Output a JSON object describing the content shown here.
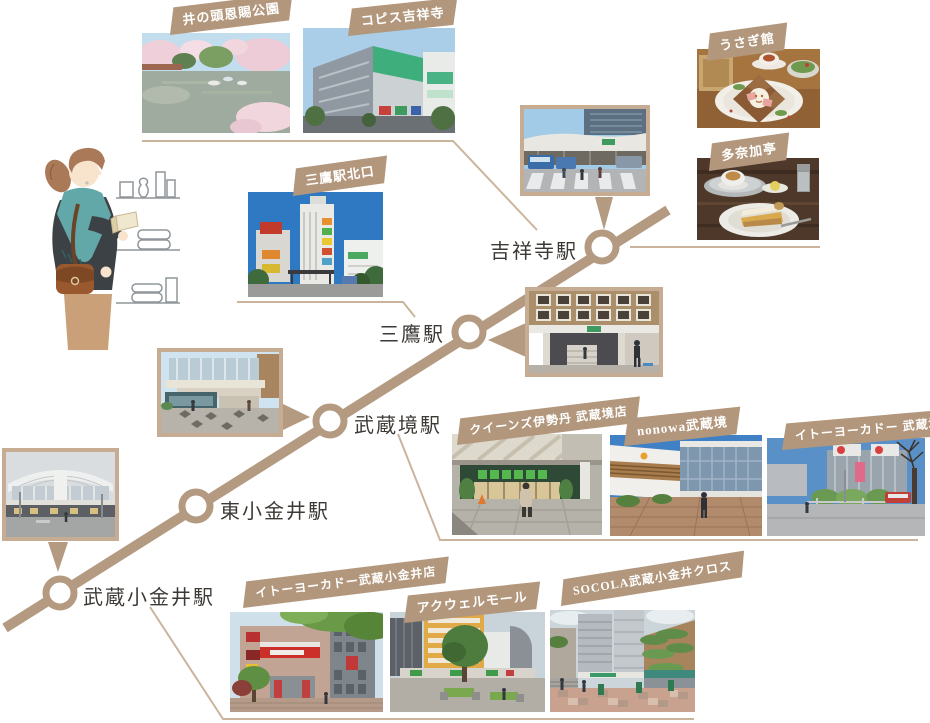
{
  "palette": {
    "rail_line": "#b49a80",
    "ribbon_bg": "#b2977c",
    "connector_line": "#cbb49c",
    "station_text": "#3d3935",
    "photo_border": "#c5ac93",
    "background": "#ffffff"
  },
  "stations": {
    "kichijoji": "吉祥寺駅",
    "mitaka": "三鷹駅",
    "musashisakai": "武蔵境駅",
    "higashikoganei": "東小金井駅",
    "musashikoganei": "武蔵小金井駅"
  },
  "ribbons": {
    "inokashira": "井の頭恩賜公園",
    "coppice": "コピス吉祥寺",
    "usagikan": "うさぎ館",
    "tanakatei": "多奈加亭",
    "mitaka_north": "三鷹駅北口",
    "queens_isetan": "クイーンズ伊勢丹 武蔵境店",
    "nonowa": "nonowa武蔵境",
    "itoyokado_sakai": "イトーヨーカドー 武蔵境店",
    "itoyokado_koganei": "イトーヨーカドー武蔵小金井店",
    "acwell": "アクウェルモール",
    "socola": "SOCOLA武蔵小金井クロス"
  },
  "photos": {
    "inokashira": "pond-with-cherry-blossoms-and-boats",
    "coppice": "green-shopping-center-building",
    "usagikan": "galette-set-on-wooden-table",
    "tanakatei": "cake-slice-with-coffee",
    "mitaka_north": "street-view-buildings-blue-sky",
    "kichijoji_station": "station-building-bus-terminal",
    "mitaka_station": "station-entrance",
    "musashisakai_station": "elevated-station-plaza",
    "musashikoganei_station": "station-facade",
    "queens_isetan": "supermarket-storefront",
    "nonowa": "station-mall-exterior",
    "itoyokado_sakai": "shopping-center-rotary",
    "itoyokado_koganei": "department-store-building",
    "acwell": "mall-plaza-with-tree",
    "socola": "shopping-complex-plaza"
  },
  "illustration": {
    "woman_shopper": "woman-browsing-shelf-items"
  }
}
